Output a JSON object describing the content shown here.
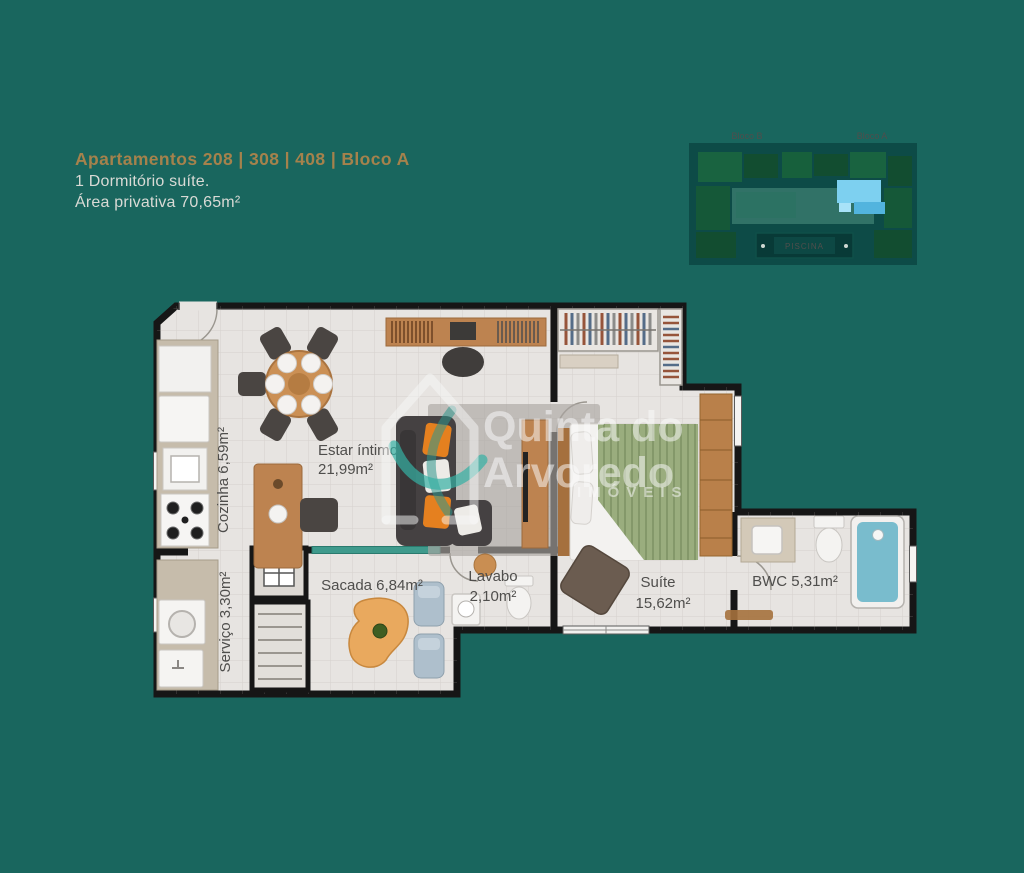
{
  "header": {
    "title": "Apartamentos 208 | 308 | 408 | Bloco A",
    "line1": "1 Dormitório suíte.",
    "line2": "Área privativa 70,65m²"
  },
  "site_map": {
    "bloco_b": "Bloco B",
    "bloco_a": "Bloco A",
    "piscina": "PISCINA"
  },
  "floor_plan": {
    "rooms": {
      "cozinha": "Cozinha 6,59m²",
      "servico": "Serviço 3,30m²",
      "estar_line1": "Estar íntimo",
      "estar_line2": "21,99m²",
      "sacada": "Sacada 6,84m²",
      "lavabo_line1": "Lavabo",
      "lavabo_line2": "2,10m²",
      "suite_line1": "Suíte",
      "suite_line2": "15,62m²",
      "bwc": "BWC 5,31m²"
    },
    "watermark": {
      "line1": "Quinta do",
      "line2": "Arvoredo",
      "line3": "IMÓVEIS"
    }
  },
  "colors": {
    "background_teal": "#19665e",
    "accent_gold": "#a5824c",
    "subtitle_gray": "#d9dad5",
    "floor": "#e7e4e1",
    "wall": "#161616",
    "wood": "#bd8350",
    "bed_green": "#9aad7e",
    "bathtub_blue": "#79bccd",
    "highlight_blue": "#7dd0f0",
    "sofa_orange": "#e5801f"
  }
}
